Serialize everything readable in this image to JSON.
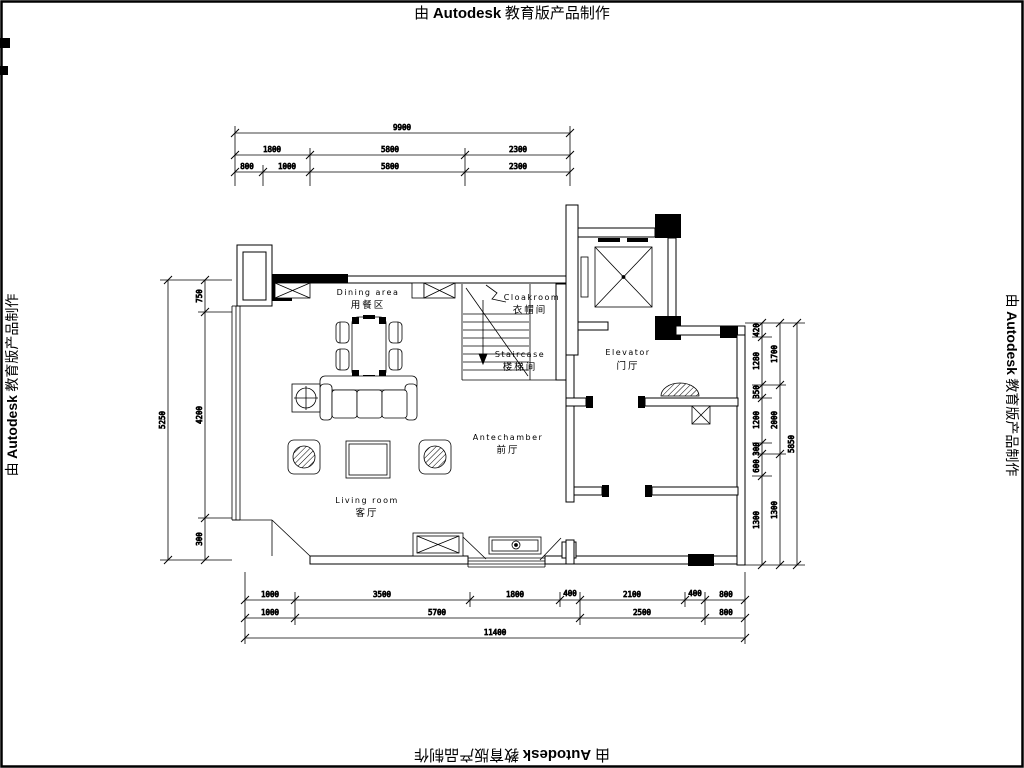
{
  "watermark": {
    "prefix": "由 ",
    "brand": "Autodesk",
    "suffix": " 教育版产品制作"
  },
  "plan": {
    "rooms": [
      {
        "id": "dining",
        "en": "Dining area",
        "zh": "用餐区"
      },
      {
        "id": "cloakroom",
        "en": "Cloakroom",
        "zh": "衣帽间"
      },
      {
        "id": "staircase",
        "en": "Staircase",
        "zh": "楼梯间"
      },
      {
        "id": "elevator",
        "en": "Elevator",
        "zh": "门厅"
      },
      {
        "id": "antechamber",
        "en": "Antechamber",
        "zh": "前厅"
      },
      {
        "id": "living",
        "en": "Living room",
        "zh": "客厅"
      }
    ]
  },
  "dimensions": {
    "top": {
      "total": "9900",
      "row2": [
        "1800",
        "5800",
        "2300"
      ],
      "row3": [
        "800",
        "1000",
        "5800",
        "2300"
      ]
    },
    "bottom": {
      "row1": [
        "1000",
        "3500",
        "1800",
        "400",
        "2100",
        "400",
        "800"
      ],
      "row2": [
        "1000",
        "5700",
        "2500",
        "800"
      ],
      "total": "11400"
    },
    "left": {
      "segments": [
        "750",
        "4200",
        "300"
      ],
      "total": "5250"
    },
    "right": {
      "inner": [
        "420",
        "1280",
        "350",
        "1200",
        "300",
        "600",
        "1300"
      ],
      "middle": [
        "1700",
        "2000",
        "1300"
      ],
      "total": "5850"
    }
  },
  "colors": {
    "ink": "#000000",
    "paper": "#ffffff"
  }
}
